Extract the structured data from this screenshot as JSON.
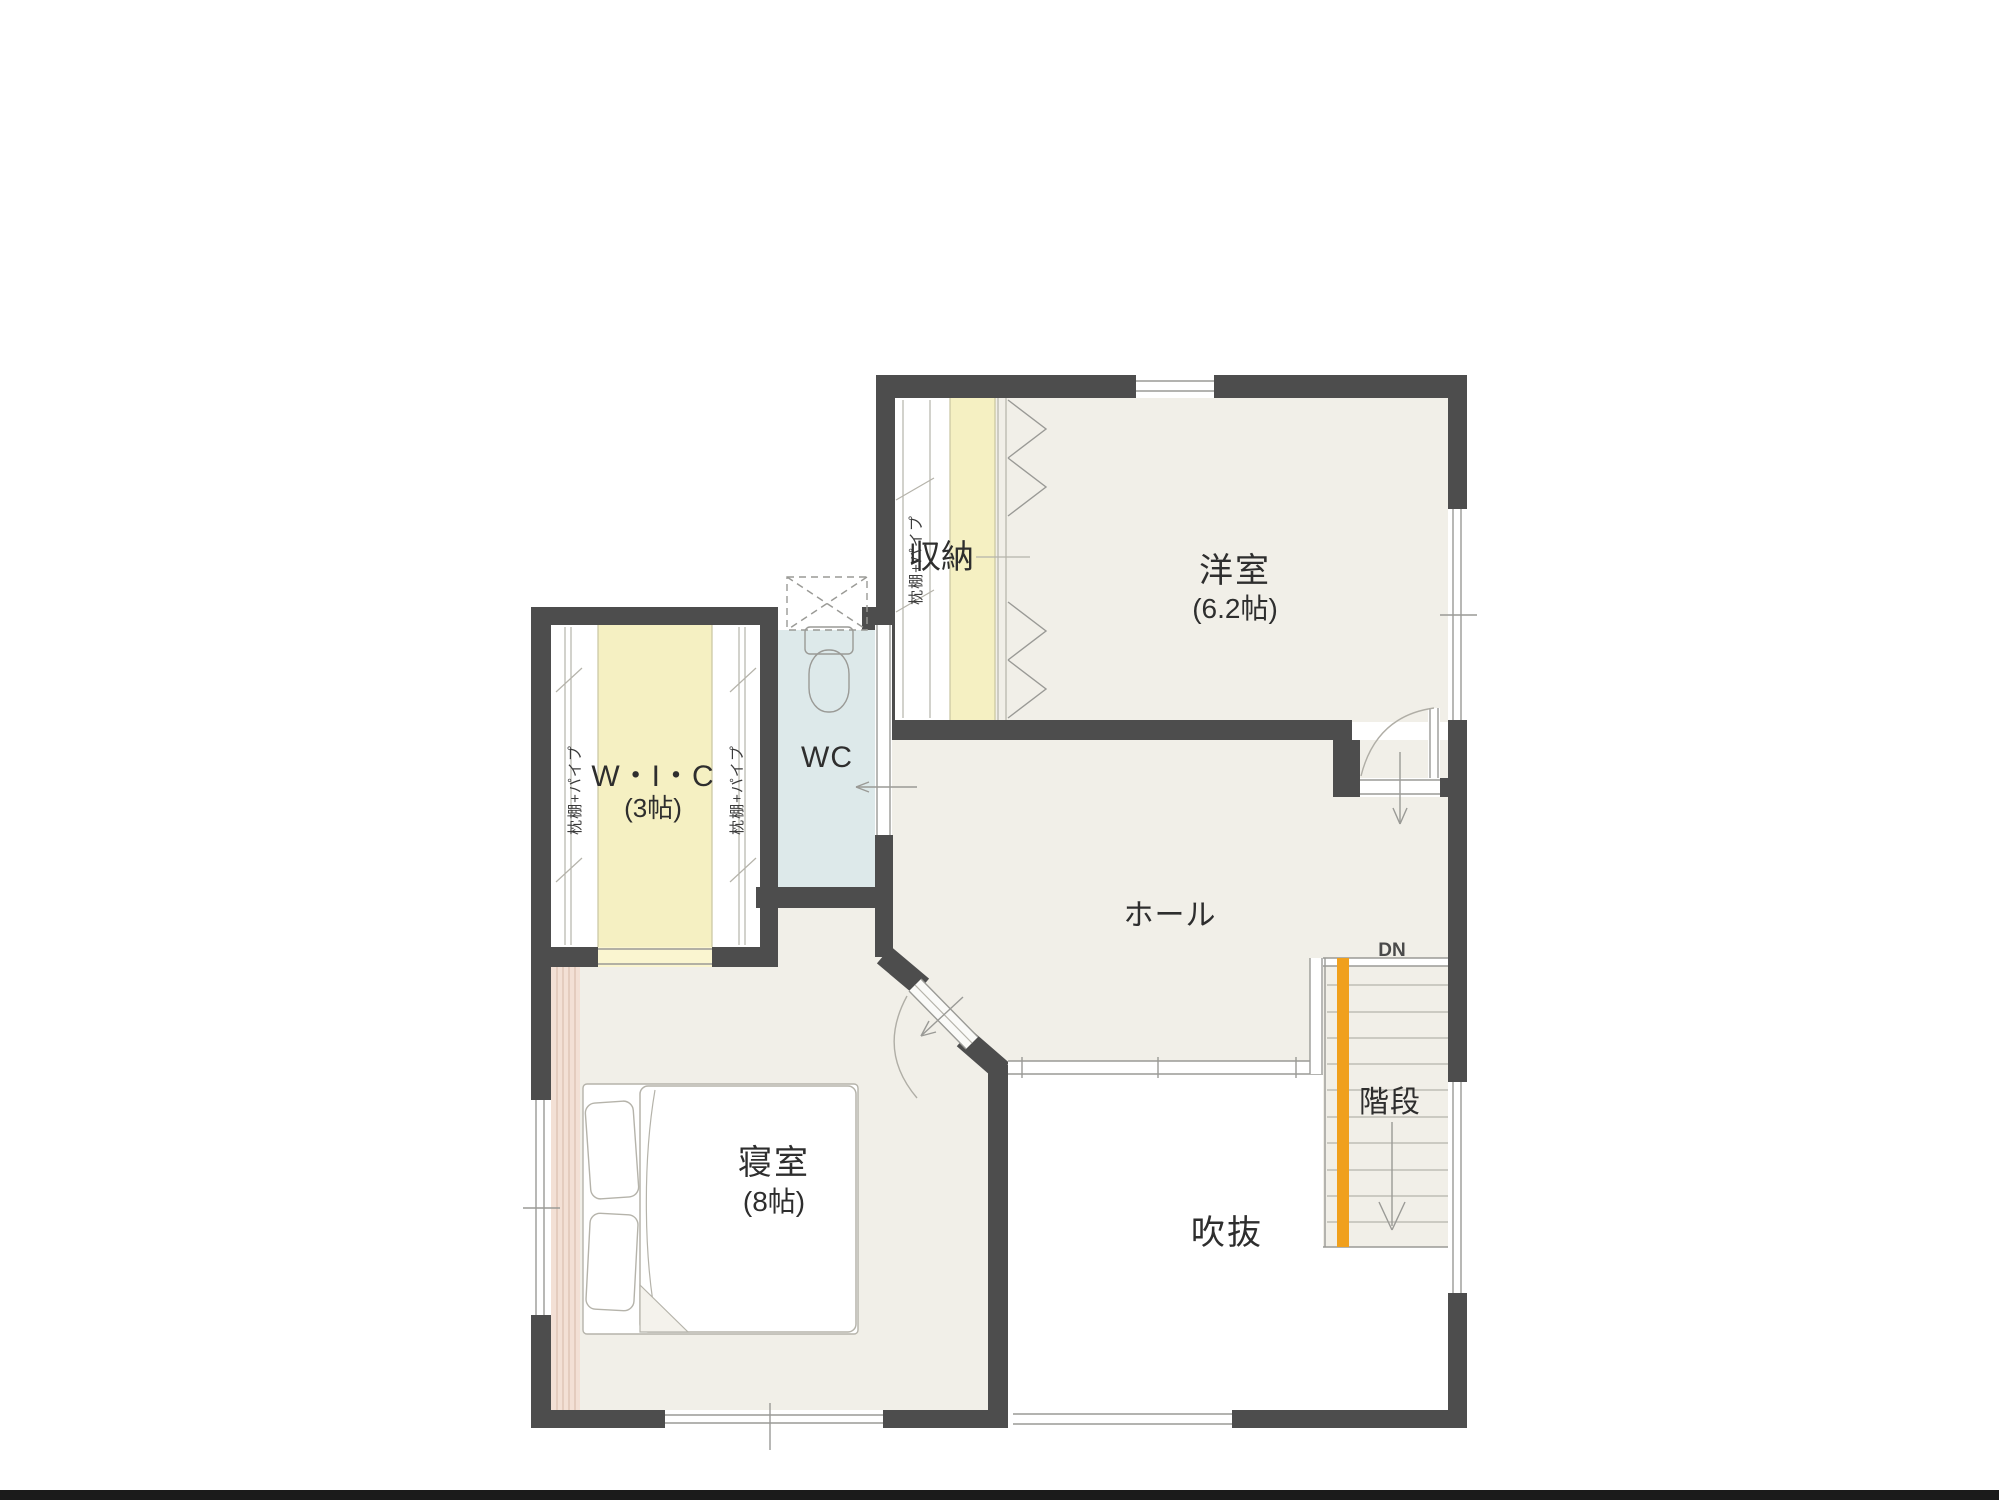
{
  "plan": {
    "rooms": {
      "western_room": {
        "name": "洋室",
        "size": "(6.2帖)"
      },
      "storage": {
        "name": "収納"
      },
      "wic": {
        "name": "W・I・C",
        "size": "(3帖)"
      },
      "wc": {
        "name": "WC"
      },
      "hall": {
        "name": "ホール"
      },
      "bedroom": {
        "name": "寝室",
        "size": "(8帖)"
      },
      "void": {
        "name": "吹抜"
      },
      "stairs": {
        "name": "階段",
        "direction": "DN"
      }
    },
    "closet_note": "枕棚+パイプ",
    "colors": {
      "wall": "#4d4d4d",
      "floor": "#f1efe8",
      "closet_yellow": "#f5f0c2",
      "wc_blue": "#dde9ea",
      "accent_pink": "#f3e0d5",
      "stair_orange": "#f0a01d",
      "void_white": "#ffffff"
    }
  }
}
